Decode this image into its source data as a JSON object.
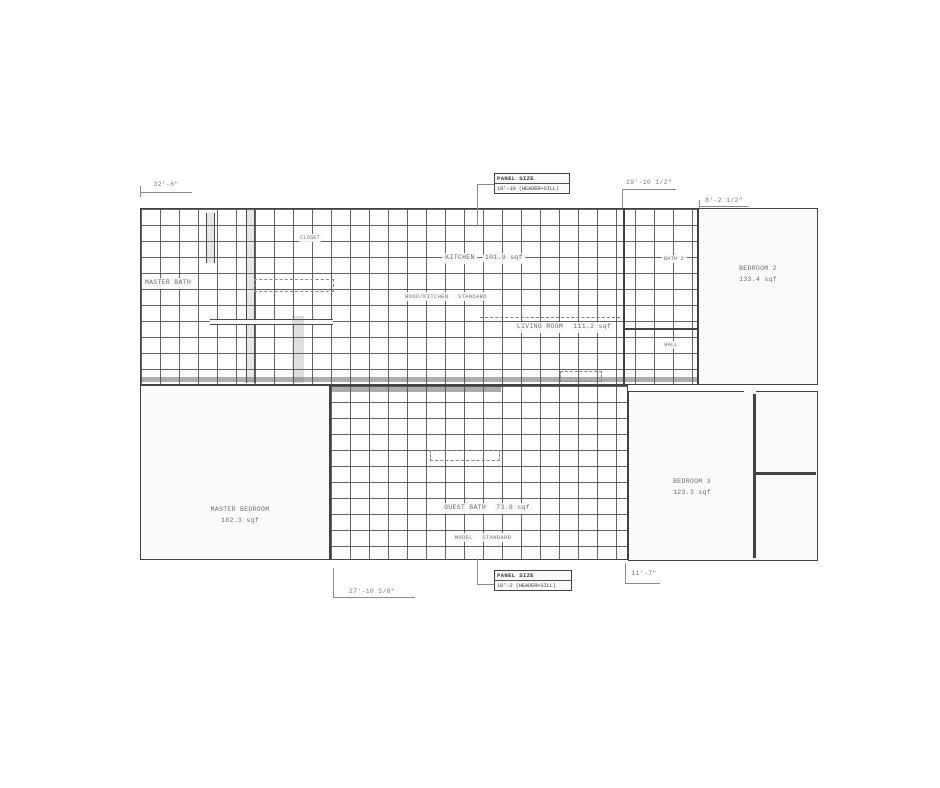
{
  "plan": {
    "dims": {
      "top_left": "32'-6\"",
      "top_mid": "19'-10 1/2\"",
      "top_right": "8'-2 1/2\"",
      "bottom_left": "27'-10 5/8\"",
      "bottom_right": "11'-7\""
    },
    "callout_top": {
      "line1": "PANEL SIZE",
      "line2": "10'-10 (HEADER+SILL)"
    },
    "callout_bottom": {
      "line1": "PANEL SIZE",
      "line2": "10'-2 (HEADER+SILL)"
    },
    "rooms": {
      "master_bath": {
        "name": "MASTER BATH"
      },
      "closet": {
        "name": "CLOSET"
      },
      "kitchen": {
        "name": "KITCHEN",
        "area": "101.9 sqf"
      },
      "kitchen_note": {
        "line1": "HOOD/KITCHEN",
        "line2": "STANDARD"
      },
      "living": {
        "name": "LIVING ROOM",
        "area": "111.2 sqf"
      },
      "bath2": {
        "name": "BATH 2"
      },
      "hall": {
        "name": "HALL"
      },
      "bedroom2": {
        "name": "BEDROOM 2",
        "area": "133.4 sqf"
      },
      "master_bedroom": {
        "name": "MASTER BEDROOM",
        "area": "182.3 sqf"
      },
      "guest_bath": {
        "name": "GUEST BATH",
        "area": "73.8 sqf"
      },
      "guest_note": {
        "line1": "MODEL",
        "line2": "STANDARD"
      },
      "bedroom3": {
        "name": "BEDROOM 3",
        "area": "123.3 sqf"
      }
    },
    "colors": {
      "wall": "#3f3f3f",
      "hatch_line": "#3c3c3c",
      "text": "#6e6e6e",
      "background": "#ffffff"
    }
  }
}
